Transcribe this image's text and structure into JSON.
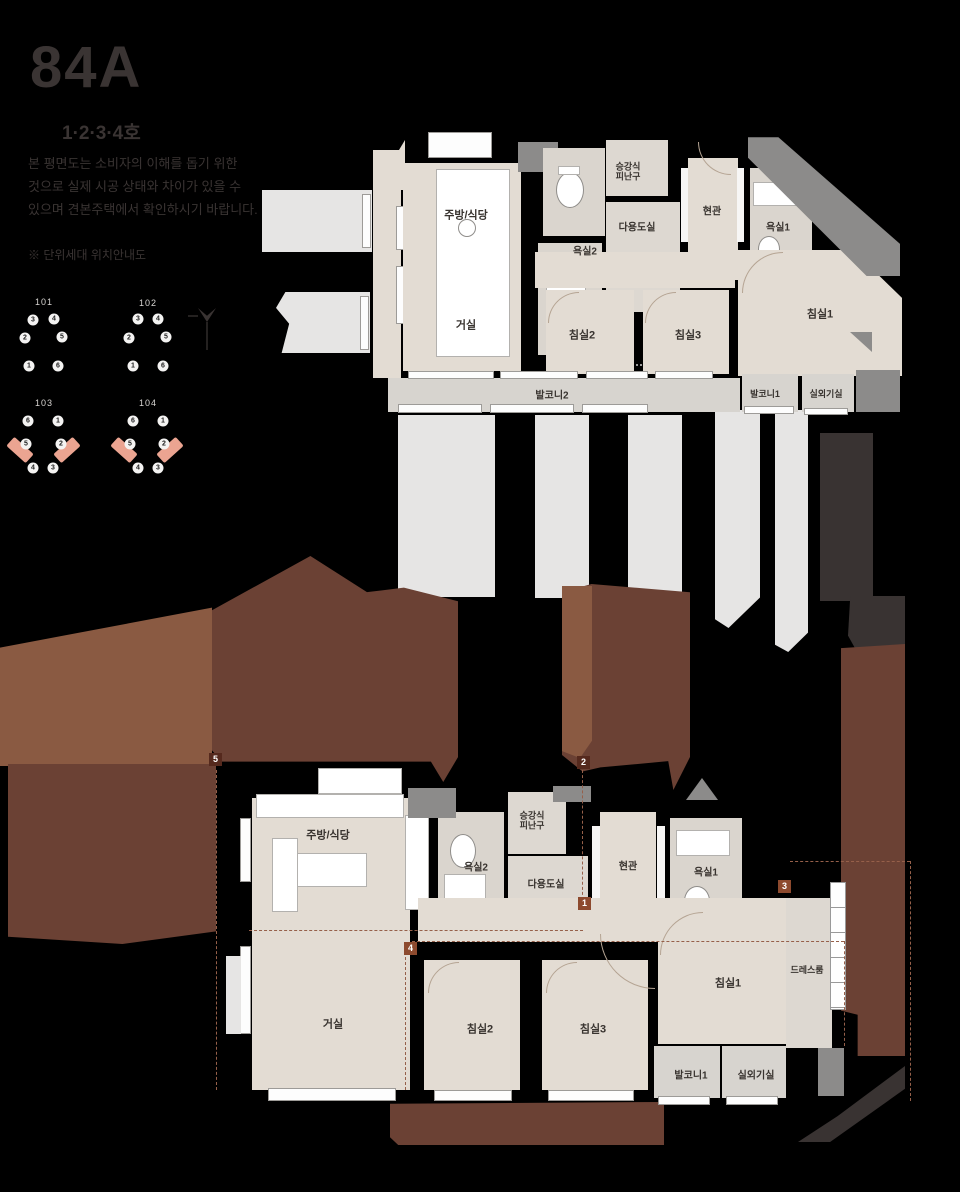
{
  "colors": {
    "background": "#000000",
    "room": "#e3dcd3",
    "bath": "#dad5ce",
    "utility": "#ddd8d1",
    "balcony": "#d7d4cf",
    "light_bar": "#e6e5e4",
    "mid_gray": "#8c8b8a",
    "dark_gray": "#393332",
    "brown": "#6b4134",
    "brown_light": "#8a5a42",
    "salmon": "#eba491",
    "badge_dark": "#55291d",
    "badge_rust": "#8d4a2e",
    "dashed_line": "#96604a",
    "title_text": "#3a3433",
    "label_text": "#38332f"
  },
  "title_block": {
    "headline": "84A",
    "unit_line": "1·2·3·4호",
    "description_lines": [
      "본 평면도는 소비자의 이해를 돕기 위한",
      "것으로 실제 시공 상태와 차이가 있을 수",
      "있으며 견본주택에서 확인하시기 바랍니다."
    ],
    "note_line": "※ 단위세대 위치안내도"
  },
  "building_diagrams": [
    {
      "id": "101",
      "label": "101",
      "lx": 44,
      "ly": 302,
      "circles": [
        {
          "n": "3",
          "x": 33,
          "y": 320
        },
        {
          "n": "4",
          "x": 54,
          "y": 319
        },
        {
          "n": "2",
          "x": 25,
          "y": 338
        },
        {
          "n": "5",
          "x": 62,
          "y": 337
        },
        {
          "n": "1",
          "x": 29,
          "y": 366
        },
        {
          "n": "6",
          "x": 58,
          "y": 366
        }
      ]
    },
    {
      "id": "102",
      "label": "102",
      "lx": 148,
      "ly": 303,
      "circles": [
        {
          "n": "3",
          "x": 138,
          "y": 319
        },
        {
          "n": "4",
          "x": 158,
          "y": 319
        },
        {
          "n": "2",
          "x": 129,
          "y": 338
        },
        {
          "n": "5",
          "x": 166,
          "y": 337
        },
        {
          "n": "1",
          "x": 133,
          "y": 366
        },
        {
          "n": "6",
          "x": 163,
          "y": 366
        }
      ]
    },
    {
      "id": "103",
      "label": "103",
      "lx": 44,
      "ly": 403,
      "circles": [
        {
          "n": "6",
          "x": 28,
          "y": 421
        },
        {
          "n": "1",
          "x": 58,
          "y": 421
        },
        {
          "n": "5",
          "x": 26,
          "y": 444,
          "hl": "left"
        },
        {
          "n": "2",
          "x": 61,
          "y": 444,
          "hl": "right"
        },
        {
          "n": "4",
          "x": 33,
          "y": 468
        },
        {
          "n": "3",
          "x": 53,
          "y": 468
        }
      ]
    },
    {
      "id": "104",
      "label": "104",
      "lx": 148,
      "ly": 403,
      "circles": [
        {
          "n": "6",
          "x": 133,
          "y": 421
        },
        {
          "n": "1",
          "x": 163,
          "y": 421
        },
        {
          "n": "5",
          "x": 130,
          "y": 444,
          "hl": "left"
        },
        {
          "n": "2",
          "x": 164,
          "y": 444,
          "hl": "right"
        },
        {
          "n": "4",
          "x": 138,
          "y": 468
        },
        {
          "n": "3",
          "x": 158,
          "y": 468
        }
      ]
    }
  ],
  "upper_plan": {
    "labels": [
      {
        "t": "주방/식당",
        "x": 466,
        "y": 216,
        "fs": 11
      },
      {
        "t": "거실",
        "x": 466,
        "y": 326,
        "fs": 11
      },
      {
        "t": "욕실2",
        "x": 585,
        "y": 252,
        "fs": 10
      },
      {
        "t": "다용도실",
        "x": 637,
        "y": 228,
        "fs": 10
      },
      {
        "t": "승강식\n피난구",
        "x": 628,
        "y": 172,
        "fs": 9
      },
      {
        "t": "현관",
        "x": 712,
        "y": 212,
        "fs": 10
      },
      {
        "t": "욕실1",
        "x": 778,
        "y": 228,
        "fs": 10
      },
      {
        "t": "침실1",
        "x": 820,
        "y": 315,
        "fs": 11
      },
      {
        "t": "침실2",
        "x": 582,
        "y": 336,
        "fs": 11
      },
      {
        "t": "침실3",
        "x": 688,
        "y": 336,
        "fs": 11
      },
      {
        "t": "발코니2",
        "x": 552,
        "y": 396,
        "fs": 10
      },
      {
        "t": "발코니1",
        "x": 765,
        "y": 394,
        "fs": 9
      },
      {
        "t": "실외기실",
        "x": 826,
        "y": 394,
        "fs": 9
      }
    ]
  },
  "lower_plan": {
    "labels": [
      {
        "t": "주방/식당",
        "x": 328,
        "y": 836,
        "fs": 11
      },
      {
        "t": "거실",
        "x": 333,
        "y": 1025,
        "fs": 11
      },
      {
        "t": "침실2",
        "x": 480,
        "y": 1030,
        "fs": 11
      },
      {
        "t": "침실3",
        "x": 593,
        "y": 1030,
        "fs": 11
      },
      {
        "t": "침실1",
        "x": 728,
        "y": 984,
        "fs": 11
      },
      {
        "t": "드레스룸",
        "x": 807,
        "y": 970,
        "fs": 9
      },
      {
        "t": "현관",
        "x": 628,
        "y": 867,
        "fs": 10
      },
      {
        "t": "욕실1",
        "x": 706,
        "y": 873,
        "fs": 10
      },
      {
        "t": "욕실2",
        "x": 476,
        "y": 868,
        "fs": 10
      },
      {
        "t": "다용도실",
        "x": 546,
        "y": 885,
        "fs": 10
      },
      {
        "t": "승강식\n피난구",
        "x": 532,
        "y": 821,
        "fs": 9
      },
      {
        "t": "발코니1",
        "x": 691,
        "y": 1076,
        "fs": 10
      },
      {
        "t": "실외기실",
        "x": 756,
        "y": 1076,
        "fs": 10
      }
    ],
    "markers": [
      {
        "n": "5",
        "x": 209,
        "y": 753,
        "c": "badge_dark"
      },
      {
        "n": "2",
        "x": 577,
        "y": 756,
        "c": "badge_dark"
      },
      {
        "n": "1",
        "x": 578,
        "y": 897,
        "c": "badge_rust"
      },
      {
        "n": "3",
        "x": 778,
        "y": 880,
        "c": "badge_rust"
      },
      {
        "n": "4",
        "x": 404,
        "y": 942,
        "c": "badge_rust"
      }
    ]
  }
}
